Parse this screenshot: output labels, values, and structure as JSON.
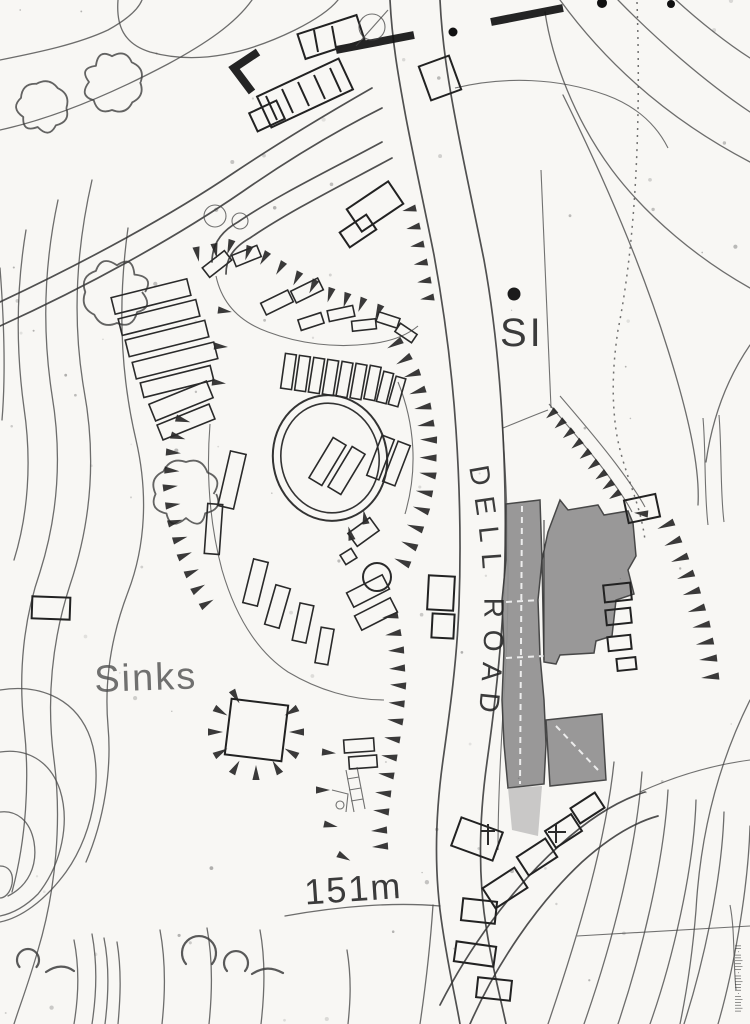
{
  "map": {
    "labels": {
      "spot_marker": "SI",
      "road_name": "DELL ROAD",
      "sinks": "Sinks",
      "elevation": "151m",
      "edge_text": "l|ll|l·lll|ll·l|l|ll·ll"
    },
    "colors": {
      "ink": "#2a2a2a",
      "contour": "#4a4a4a",
      "building_fill": "#919191",
      "faded_label": "#4f4f4f",
      "background": "#f8f7f4"
    }
  }
}
